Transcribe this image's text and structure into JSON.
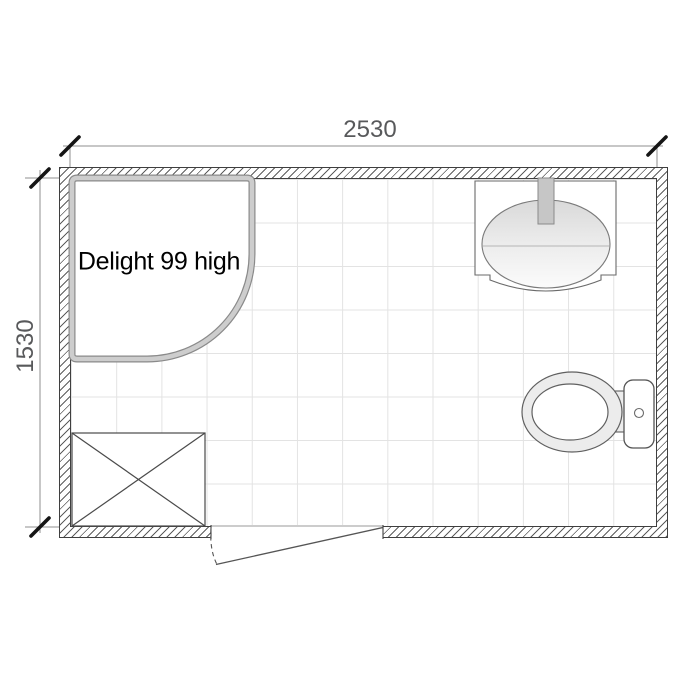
{
  "floor_plan": {
    "dimension_width_label": "2530",
    "dimension_height_label": "1530",
    "shower_label": "Delight 99 high",
    "fixtures": {
      "shower": "quarter-round-shower-enclosure",
      "washbasin": "countertop-basin-with-tap",
      "toilet": "toilet-with-cistern",
      "appliance": "crossed-box-appliance-space",
      "door": "outward-swinging-door"
    },
    "colors": {
      "dimension_text": "#58595b",
      "dimension_line": "#8f8f8f",
      "tick": "#151515",
      "wall_line": "#3f3f3f",
      "hatch_line": "#5d5d5d",
      "tile_grid": "#e3e3e3",
      "shower_frame_band": "#cdcdcd",
      "shower_frame_edge": "#8a8a8a",
      "fixture_line": "#606060",
      "faucet_fill": "#c6c6c6",
      "toilet_seat_fill": "#ececec",
      "label_text": "#000000"
    }
  }
}
